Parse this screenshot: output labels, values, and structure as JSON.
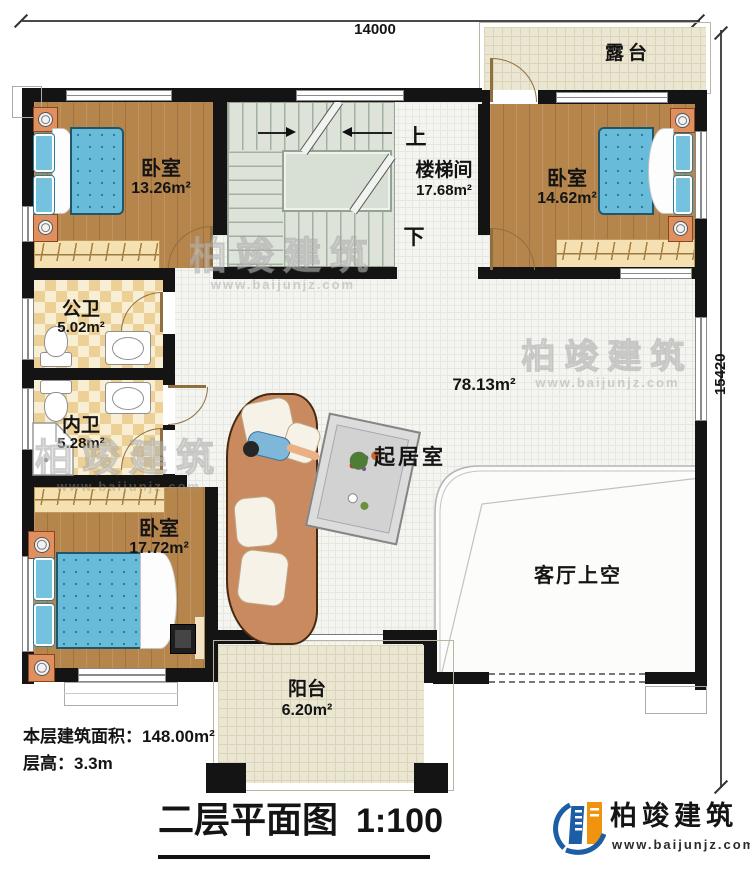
{
  "plan": {
    "dim_top": "14000",
    "dim_right": "15420",
    "title": "二层平面图",
    "scale": "1:100",
    "area_note": "本层建筑面积：148.00m²",
    "floor_height_note": "层高：3.3m"
  },
  "rooms": {
    "terrace": {
      "name": "露台"
    },
    "bedroom_tl": {
      "name": "卧室",
      "area": "13.26m²"
    },
    "stairwell": {
      "name": "楼梯间",
      "area": "17.68m²",
      "up": "上",
      "down": "下"
    },
    "bedroom_tr": {
      "name": "卧室",
      "area": "14.62m²"
    },
    "public_bath": {
      "name": "公卫",
      "area": "5.02m²"
    },
    "inner_bath": {
      "name": "内卫",
      "area": "5.28m²"
    },
    "bedroom_bl": {
      "name": "卧室",
      "area": "17.72m²"
    },
    "living": {
      "name": "起居室",
      "area": "78.13m²"
    },
    "living_void": {
      "name": "客厅上空"
    },
    "balcony": {
      "name": "阳台",
      "area": "6.20m²"
    }
  },
  "branding": {
    "brand": "柏竣建筑",
    "website": "www.baijunjz.com"
  },
  "colors": {
    "wall": "#141414",
    "wood": "#b6854c",
    "bed_blue": "#68bcd9",
    "bath_tile": "#ecd096",
    "stair": "#dde3d9",
    "terrace_tile": "#eae6d2",
    "logo_blue": "#1b5ea6",
    "logo_orange": "#f0930f"
  }
}
